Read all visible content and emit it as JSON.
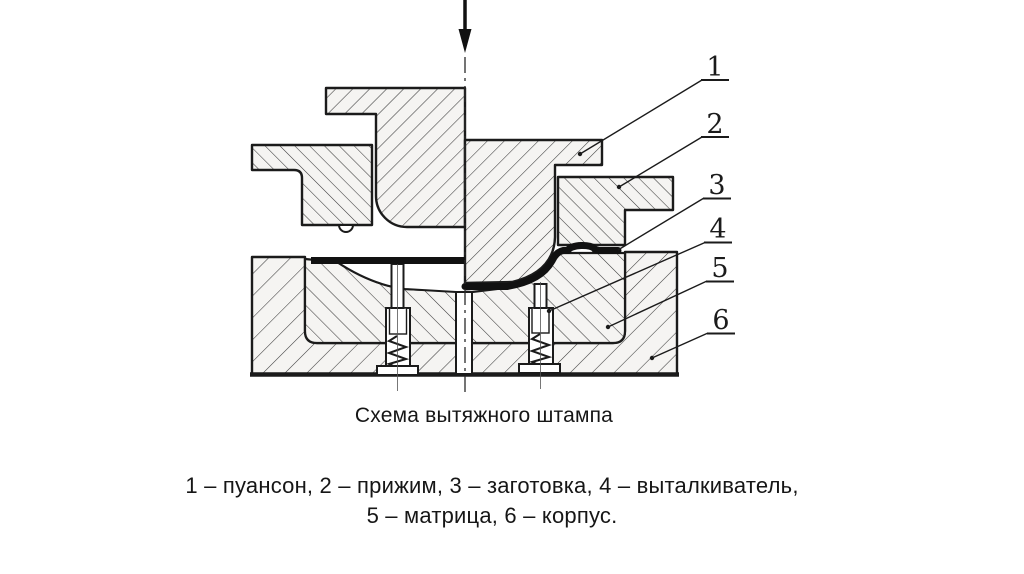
{
  "figure": {
    "caption": "Схема вытяжного штампа",
    "legend": [
      "1 – пуансон, 2 – прижим, 3 – заготовка, 4 – выталкиватель,",
      "5 – матрица, 6 – корпус."
    ],
    "callouts": [
      {
        "number": "1",
        "label": "пуансон"
      },
      {
        "number": "2",
        "label": "прижим"
      },
      {
        "number": "3",
        "label": "заготовка"
      },
      {
        "number": "4",
        "label": "выталкиватель"
      },
      {
        "number": "5",
        "label": "матрица"
      },
      {
        "number": "6",
        "label": "корпус"
      }
    ],
    "icons": {
      "press_direction": "down-arrow-icon"
    },
    "colors": {
      "ink": "#1b1b1b",
      "hatch": "#3c3c3c",
      "paper": "#ffffff",
      "piece_tint": "#f5f4f2"
    }
  }
}
